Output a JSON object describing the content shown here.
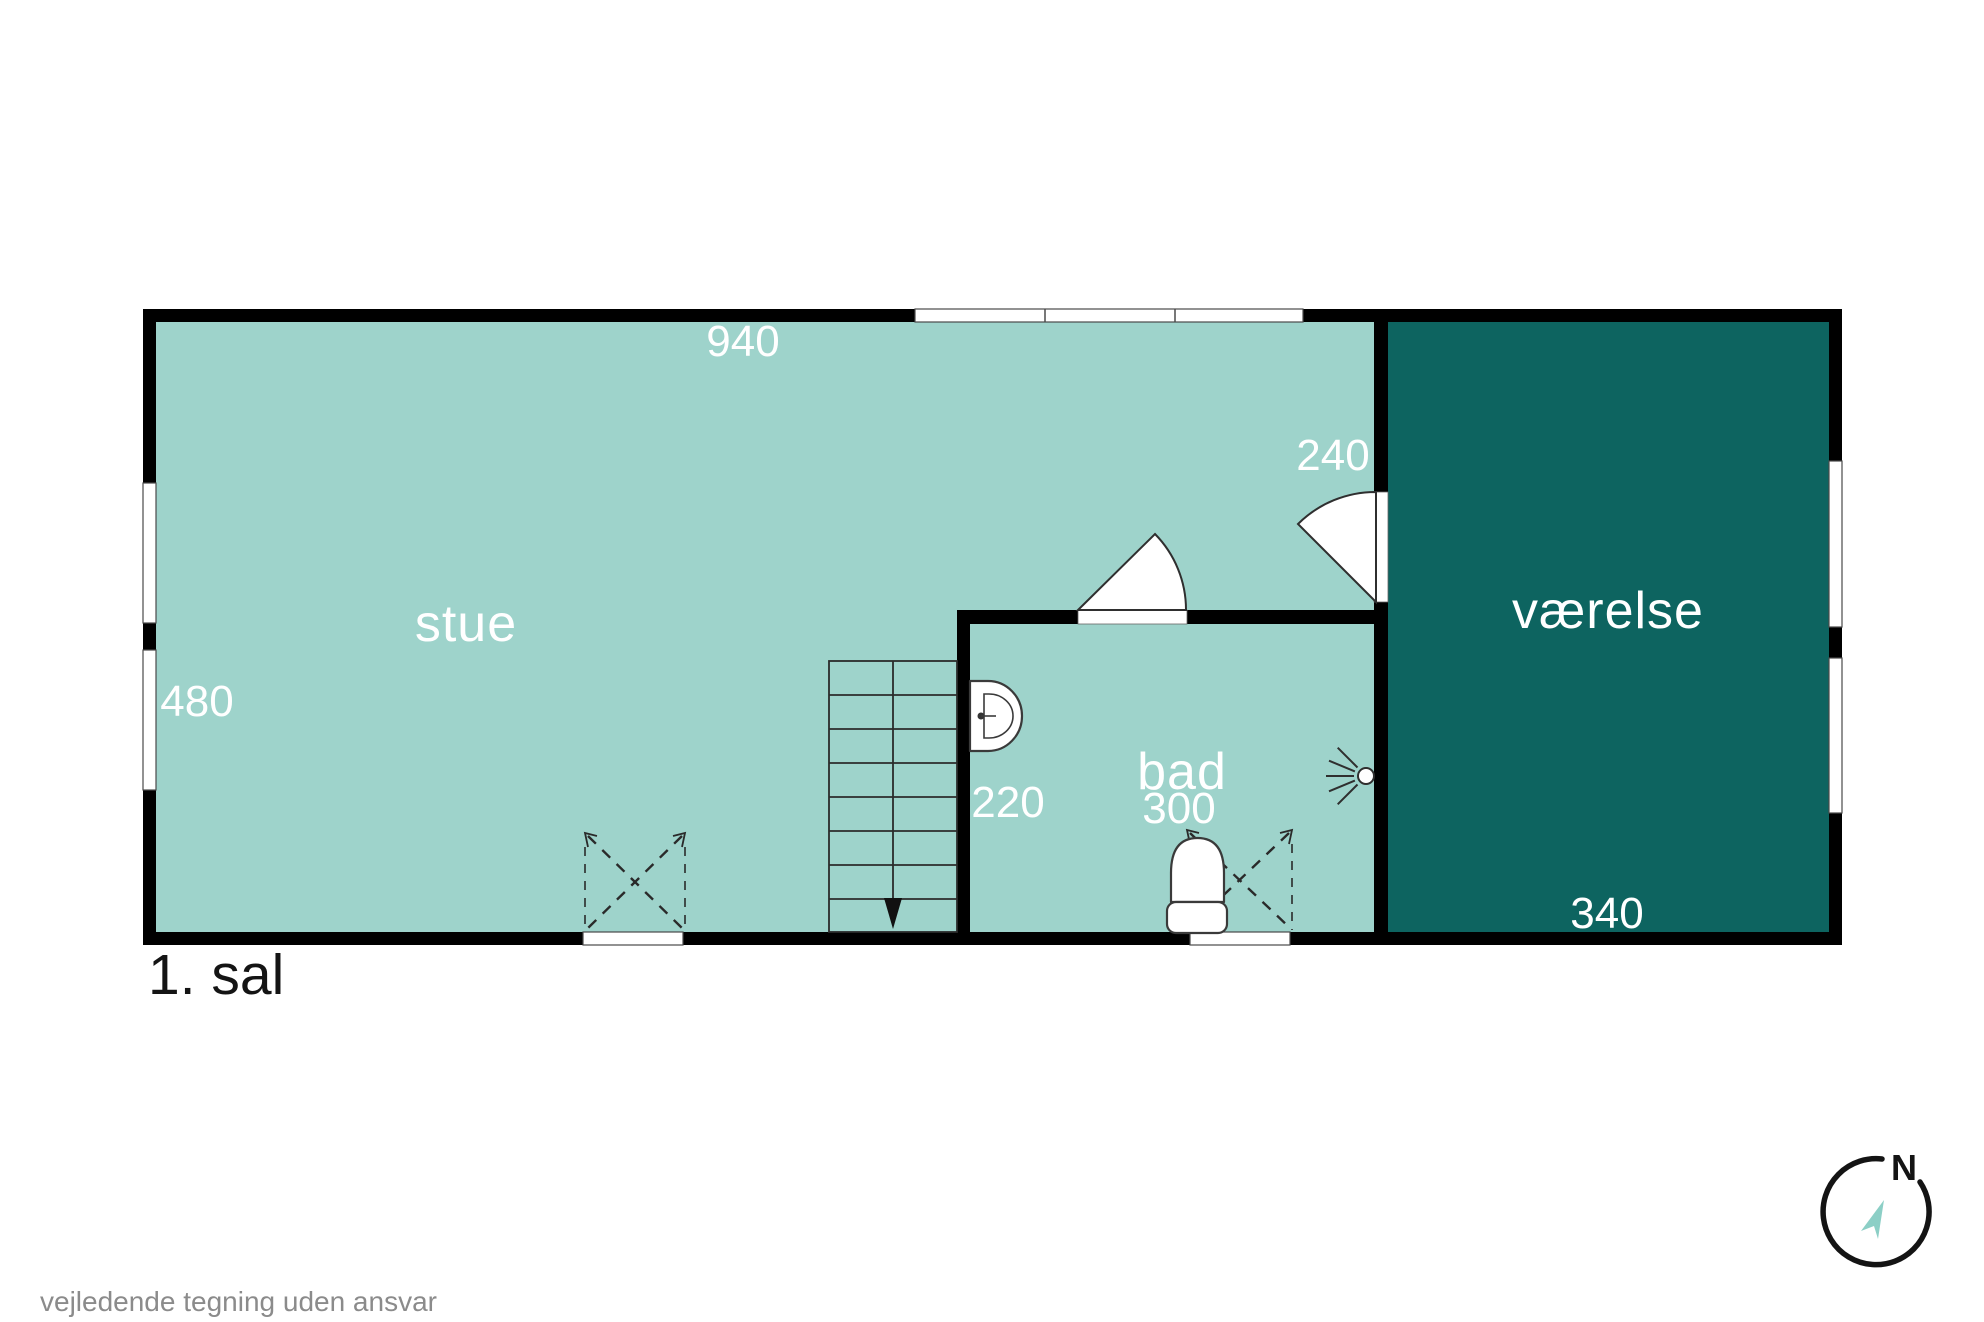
{
  "page": {
    "floor_label": "1. sal",
    "disclaimer": "vejledende tegning uden ansvar"
  },
  "rooms": {
    "stue": {
      "label": "stue"
    },
    "bad": {
      "label": "bad"
    },
    "vaerelse": {
      "label": "værelse"
    }
  },
  "dimensions": {
    "top_width": "940",
    "left_height": "480",
    "vaerelse_door": "240",
    "hall_width": "220",
    "bad_width": "300",
    "vaerelse_width": "340"
  },
  "compass": {
    "north": "N"
  },
  "colors": {
    "floor_light": "#9ed3cb",
    "floor_dark": "#0d6460",
    "wall": "#000000",
    "dimension_text": "#ffffff",
    "disclaimer_text": "#8b8b8b",
    "compass_arrow": "#8ccfc6"
  }
}
